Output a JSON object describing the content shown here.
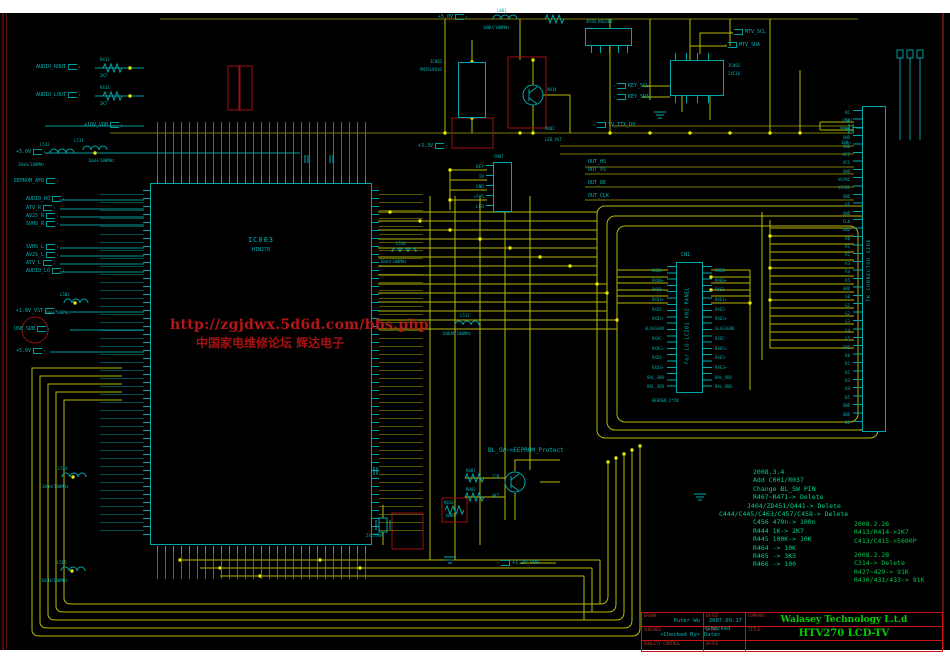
{
  "watermark": {
    "line1": "http://zgjdwx.5d6d.com/bbs.php",
    "line2": "中国家电维修论坛  辉达电子"
  },
  "components": {
    "main_ic": {
      "ref": "IC003",
      "part": "HIN270"
    },
    "eeprom": {
      "ref": "IC001",
      "part": "24C16"
    },
    "flash": {
      "ref": "IC002",
      "part": "PM25LV010"
    },
    "lvds_connector": {
      "ref": "CN1",
      "label": "For LG LC201 V02 PANEL",
      "footprint": "HEADER_2*20"
    },
    "ttl_connector": {
      "label": "TK_CONNECTOR_SIDE"
    },
    "holder": {
      "label": "4PIN_HOLDER"
    },
    "keypad_header": {
      "ref": "CN07",
      "pins": [
        "KEY",
        "IR",
        "GND",
        "+5VS",
        "LED"
      ]
    },
    "transistor": {
      "part": "9014"
    },
    "crystal": {
      "value": "24.576M"
    },
    "inductors": [
      {
        "ref": "L001",
        "value": "100U/100MHz"
      },
      {
        "ref": "L511",
        "value": "10uH/100MHz"
      },
      {
        "ref": "L512",
        "value": "10uH/100MHz"
      },
      {
        "ref": "L502",
        "value": "10uH/100MHz"
      },
      {
        "ref": "L516",
        "value": "10uH/100MHz"
      },
      {
        "ref": "L505",
        "value": "10uH/100MHz"
      },
      {
        "ref": "L510",
        "value": "10uH/100MHz"
      },
      {
        "ref": "L513",
        "value": "100UH/100MHz"
      }
    ],
    "resistors": [
      {
        "ref": "R413",
        "value": "2K7"
      },
      {
        "ref": "R414",
        "value": "2K7"
      },
      {
        "ref": "R007",
        "value": "22R"
      },
      {
        "ref": "R002",
        "value": "4K7"
      },
      {
        "ref": "R016",
        "value": "100R"
      }
    ],
    "caps": [
      {
        "ref": "C501",
        "value": "100n"
      }
    ]
  },
  "signals": {
    "left_top": [
      "AUDIO_ROUT",
      "AUDIO_LOUT"
    ],
    "power1": "+10V_VDB",
    "power2": "+5.0V",
    "eeprom_afd": "EEPROM_AFD",
    "audio_in": [
      "AUDIO_RO",
      "ATV_R",
      "AV2S_R",
      "SVHS_R"
    ],
    "audio_in2": [
      "SVHS_L",
      "AV2S_L",
      "ATV_L",
      "AUDIO_LO"
    ],
    "vst": "+1.8V_VST",
    "usb": "USB_SDB",
    "power3": "+5.0V",
    "p50_top": "+5.0V",
    "p33": "+3.3V",
    "out": [
      "OUT_HS",
      "OUT_VS",
      "OUT_DE",
      "OUT_CLK"
    ],
    "mtv": [
      "MTV_SCL",
      "MTV_SDA"
    ],
    "key": [
      "KEY_SCL",
      "KEY_SDA"
    ],
    "ttx": "TV_TTX_DV",
    "blsw": "BL_SW~>EEPROM_Protect",
    "vdd": "+1.2V_VDD",
    "r002": "R002",
    "led_vst": "LED_VST"
  },
  "panel_pins": {
    "left": [
      "RXO0-",
      "RXO0+",
      "RXO1-",
      "RXO1+",
      "RXO2-",
      "RXO2+",
      "GLASSGND",
      "RXOC-",
      "RXOC+",
      "RXO3-",
      "RXO3+",
      "BAL_GND",
      "BAL_VDD"
    ],
    "right": [
      "RXE0-",
      "RXE0+",
      "RXE1-",
      "RXE1+",
      "RXE2-",
      "RXE2+",
      "GLASSGND",
      "RXEC-",
      "RXEC+",
      "RXE3-",
      "RXE3+",
      "BAL_VDD",
      "BAL_GND"
    ]
  },
  "ttl_pins": [
    "NC",
    "NC",
    "NC",
    "GND",
    "GND",
    "VCC",
    "VCC",
    "GND",
    "HSYNC",
    "VSYNC",
    "GND",
    "DE",
    "GND",
    "CLK",
    "GND",
    "R0",
    "R1",
    "R2",
    "R3",
    "R4",
    "R5",
    "GND",
    "G0",
    "G1",
    "G2",
    "G3",
    "G4",
    "G5",
    "GND",
    "B0",
    "B1",
    "B2",
    "B3",
    "B4",
    "B5",
    "GND",
    "GND",
    "NC"
  ],
  "revision_notes": {
    "block1": [
      "2008.3.4",
      "Add C001/R037",
      "Change BL_SW PIN",
      "R467~R471-> Delete",
      "J404/ZD451/Q441-> Delete",
      "C444/C445/C463/C457/C458-> Delete",
      "C456 470n-> 100n",
      "R444 1K-> 2K7",
      "R445 100K-> 10K",
      "R464 -> 10K",
      "R465 -> 3K3",
      "R466 -> 100"
    ],
    "block2": [
      "2008.2.26",
      "R413/R414->2K7",
      "C413/C415->5600P"
    ],
    "block3": [
      "2008.2.28",
      "C314-> Delete",
      "R427~429-> 91K",
      "R430/431/433-> 91K"
    ]
  },
  "title_block": {
    "drawn_label": "DRAWN",
    "drawn": "Puter Wu",
    "dated1_label": "DATED",
    "dated1": "2007.09.17",
    "company_label": "COMPANY:",
    "company": "Walasey Technology L.t.d",
    "checked_label": "CHECKED",
    "checked": "<Checked By>",
    "dated2_label": "DATED",
    "dated2": "<Checked Date>",
    "title_label": "TITLE",
    "title": "HTV270 LCD-TV",
    "qc_label": "QUALITY CONTROL",
    "dated3_label": "DATED"
  }
}
